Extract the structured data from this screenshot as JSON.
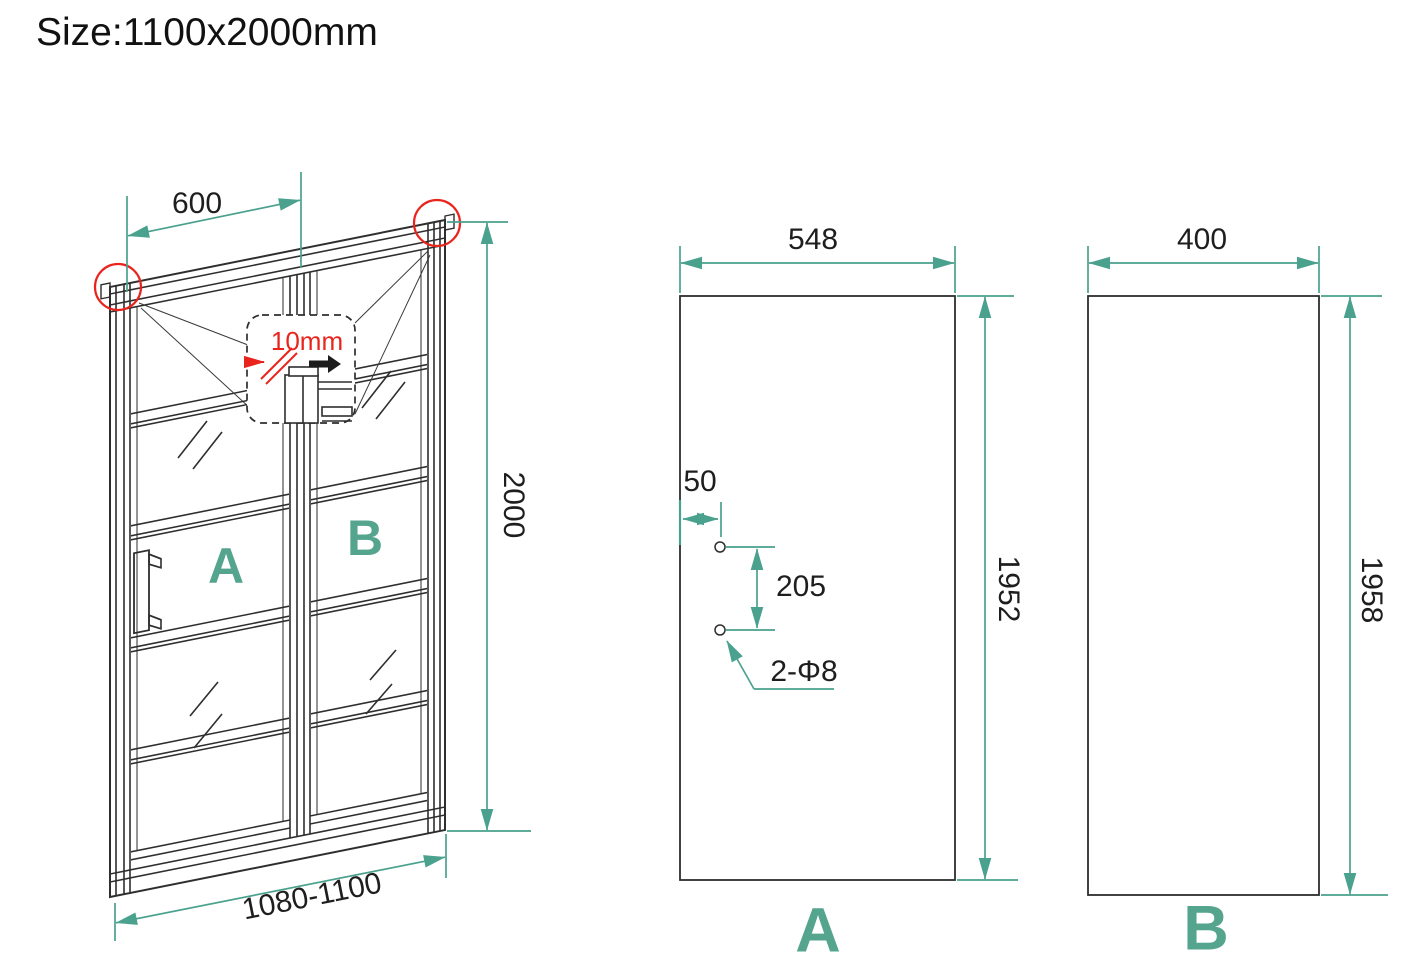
{
  "title": "Size:1100x2000mm",
  "colors": {
    "dimension_teal": "#4AA18D",
    "label_teal": "#55A48E",
    "accent_red": "#E9241C",
    "line_black": "#2E2E2E"
  },
  "perspective_view": {
    "top_width": "600",
    "height": "2000",
    "bottom_width_range": "1080-1100",
    "door_label": "A",
    "fixed_panel_label": "B",
    "detail_glass_thickness": "10mm"
  },
  "panel_a_view": {
    "width": "548",
    "height": "1952",
    "hole_edge_offset": "50",
    "hole_spacing": "205",
    "holes_note": "2-Φ8",
    "label": "A"
  },
  "panel_b_view": {
    "width": "400",
    "height": "1958",
    "label": "B"
  }
}
